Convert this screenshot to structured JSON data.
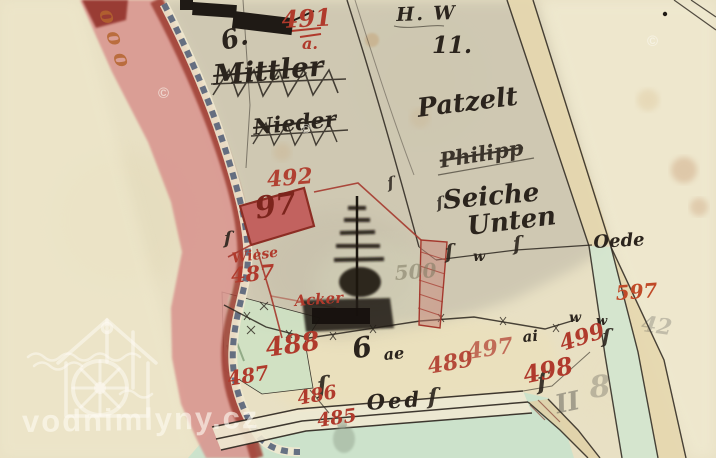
{
  "app": {
    "description": "scanned historical cadastral map sheet"
  },
  "watermark": {
    "text": "vodnimlyny.cz",
    "copyright_glyph": "©"
  },
  "colors": {
    "paper": "#e8e0c4",
    "map_wash": "#c9c3ae",
    "boundary_pink": "#d9958f",
    "boundary_dark_red": "#9e3c31",
    "chain_blue": "#44536f",
    "parcel_red_ink": "#b03a2c",
    "house_97_fill": "#c2625f",
    "green_meadow": "#c9e2cc",
    "road_tan": "#e6d7ae",
    "black_ink": "#2b241d"
  },
  "labels": [
    {
      "name": "hw-label",
      "text": "H. W",
      "x": 396,
      "y": 6,
      "size": 19,
      "rot": -2,
      "color": "#2b241d",
      "cls": "hand",
      "ls": 2
    },
    {
      "name": "parcel-11",
      "text": "11.",
      "x": 432,
      "y": 34,
      "size": 23,
      "rot": 0,
      "color": "#2b241d",
      "cls": "num"
    },
    {
      "name": "name-patzelt",
      "text": "Patzelt",
      "x": 416,
      "y": 96,
      "size": 26,
      "rot": -7,
      "color": "#2b241d",
      "cls": "hand"
    },
    {
      "name": "name-philipp",
      "text": "Philipp",
      "x": 438,
      "y": 150,
      "size": 21,
      "rot": -9,
      "color": "#2b241d",
      "cls": "hand",
      "deco": "line-through",
      "op": 0.9
    },
    {
      "name": "name-seiche",
      "text": "Seiche",
      "x": 442,
      "y": 188,
      "size": 26,
      "rot": -5,
      "color": "#2b241d",
      "cls": "hand"
    },
    {
      "name": "name-unten",
      "text": "Unten",
      "x": 466,
      "y": 214,
      "size": 26,
      "rot": -7,
      "color": "#2b241d",
      "cls": "hand"
    },
    {
      "name": "name-mittler-struck",
      "text": "Mittler",
      "x": 212,
      "y": 62,
      "size": 28,
      "rot": -5,
      "color": "#2b241d",
      "cls": "hand",
      "deco": "line-through"
    },
    {
      "name": "name-nieder-struck",
      "text": "Nieder",
      "x": 252,
      "y": 117,
      "size": 22,
      "rot": -6,
      "color": "#2b241d",
      "cls": "hand",
      "deco": "line-through"
    },
    {
      "name": "house-no-6",
      "text": "6.",
      "x": 218,
      "y": 30,
      "size": 26,
      "rot": -15,
      "color": "#2b241d",
      "cls": "hand"
    },
    {
      "name": "oede-label",
      "text": "Oede",
      "x": 593,
      "y": 234,
      "size": 18,
      "rot": -3,
      "color": "#2b241d",
      "cls": "hand"
    },
    {
      "name": "oed-road-label",
      "text": "Oed",
      "x": 366,
      "y": 392,
      "size": 21,
      "rot": -4,
      "color": "#2b241d",
      "cls": "hand",
      "ls": 3
    },
    {
      "name": "area-6",
      "text": "6",
      "x": 350,
      "y": 336,
      "size": 28,
      "rot": -10,
      "color": "#2b241d",
      "cls": "hand"
    },
    {
      "name": "area-ae",
      "text": "ae",
      "x": 383,
      "y": 347,
      "size": 16,
      "rot": -5,
      "color": "#2b241d",
      "cls": "hand"
    },
    {
      "name": "area-ai",
      "text": "ai",
      "x": 522,
      "y": 330,
      "size": 15,
      "rot": -5,
      "color": "#2b241d",
      "cls": "hand"
    },
    {
      "name": "wiese-mark-1",
      "text": "w",
      "x": 473,
      "y": 250,
      "size": 14,
      "rot": 0,
      "color": "#2b241d",
      "cls": "hand"
    },
    {
      "name": "wiese-mark-2",
      "text": "w",
      "x": 569,
      "y": 311,
      "size": 14,
      "rot": 0,
      "color": "#2b241d",
      "cls": "hand"
    },
    {
      "name": "wiese-mark-3",
      "text": "w",
      "x": 596,
      "y": 315,
      "size": 13,
      "rot": 0,
      "color": "#2b241d",
      "cls": "hand"
    },
    {
      "name": "hook-1",
      "text": "ſ",
      "x": 444,
      "y": 242,
      "size": 20,
      "rot": -5,
      "color": "#2b241d",
      "cls": "hand",
      "op": 0.9
    },
    {
      "name": "hook-2",
      "text": "ſ",
      "x": 512,
      "y": 234,
      "size": 20,
      "rot": -5,
      "color": "#2b241d",
      "cls": "hand",
      "op": 0.9
    },
    {
      "name": "hook-3",
      "text": "ſ",
      "x": 224,
      "y": 230,
      "size": 18,
      "rot": 0,
      "color": "#2b241d",
      "cls": "hand",
      "op": 0.9
    },
    {
      "name": "hook-4",
      "text": "ſ",
      "x": 316,
      "y": 374,
      "size": 24,
      "rot": -5,
      "color": "#2b241d",
      "cls": "hand",
      "op": 0.9
    },
    {
      "name": "hook-5",
      "text": "ſ",
      "x": 536,
      "y": 370,
      "size": 24,
      "rot": -5,
      "color": "#2b241d",
      "cls": "hand",
      "op": 0.9
    },
    {
      "name": "hook-6",
      "text": "ſ",
      "x": 602,
      "y": 326,
      "size": 20,
      "rot": 0,
      "color": "#2b241d",
      "cls": "hand",
      "op": 0.9
    },
    {
      "name": "hook-7",
      "text": "ſ",
      "x": 386,
      "y": 176,
      "size": 16,
      "rot": -10,
      "color": "#2b241d",
      "cls": "hand",
      "op": 0.85
    },
    {
      "name": "hook-8",
      "text": "ſ",
      "x": 435,
      "y": 196,
      "size": 16,
      "rot": -10,
      "color": "#2b241d",
      "cls": "hand",
      "op": 0.85
    },
    {
      "name": "hook-9",
      "text": "ſ",
      "x": 428,
      "y": 386,
      "size": 22,
      "rot": 0,
      "color": "#2b241d",
      "cls": "hand",
      "op": 0.9
    },
    {
      "name": "num-491",
      "text": "491",
      "x": 281,
      "y": 8,
      "size": 24,
      "rot": -3,
      "color": "#b03a2c",
      "cls": "num"
    },
    {
      "name": "num-491-a",
      "text": "a.",
      "x": 302,
      "y": 36,
      "size": 16,
      "rot": 0,
      "color": "#b03a2c",
      "cls": "hand"
    },
    {
      "name": "num-492",
      "text": "492",
      "x": 266,
      "y": 169,
      "size": 22,
      "rot": -5,
      "color": "#b03a2c",
      "cls": "num",
      "op": 0.95
    },
    {
      "name": "num-97",
      "text": "97",
      "x": 253,
      "y": 195,
      "size": 30,
      "rot": -9,
      "color": "#7c241c",
      "cls": "num"
    },
    {
      "name": "label-wiese",
      "text": "Wiese",
      "x": 231,
      "y": 252,
      "size": 14,
      "rot": -8,
      "color": "#b03a2c",
      "cls": "hand"
    },
    {
      "name": "num-487-a",
      "text": "487",
      "x": 230,
      "y": 265,
      "size": 21,
      "rot": -5,
      "color": "#b03a2c",
      "cls": "num"
    },
    {
      "name": "label-acker",
      "text": "Acker",
      "x": 294,
      "y": 294,
      "size": 15,
      "rot": -4,
      "color": "#b03a2c",
      "cls": "hand"
    },
    {
      "name": "num-488",
      "text": "488",
      "x": 264,
      "y": 336,
      "size": 26,
      "rot": -8,
      "color": "#b03a2c",
      "cls": "num"
    },
    {
      "name": "num-487-b",
      "text": "487",
      "x": 226,
      "y": 369,
      "size": 20,
      "rot": -9,
      "color": "#b03a2c",
      "cls": "num"
    },
    {
      "name": "num-486",
      "text": "486",
      "x": 296,
      "y": 390,
      "size": 19,
      "rot": -10,
      "color": "#b03a2c",
      "cls": "num"
    },
    {
      "name": "num-485",
      "text": "485",
      "x": 316,
      "y": 412,
      "size": 19,
      "rot": -8,
      "color": "#b03a2c",
      "cls": "num"
    },
    {
      "name": "num-489",
      "text": "489",
      "x": 426,
      "y": 356,
      "size": 22,
      "rot": -10,
      "color": "#b03a2c",
      "cls": "num",
      "op": 0.9
    },
    {
      "name": "num-497",
      "text": "497",
      "x": 466,
      "y": 341,
      "size": 22,
      "rot": -8,
      "color": "#b03a2c",
      "cls": "num",
      "op": 0.7
    },
    {
      "name": "num-498",
      "text": "498",
      "x": 521,
      "y": 364,
      "size": 24,
      "rot": -12,
      "color": "#b03a2c",
      "cls": "num"
    },
    {
      "name": "num-499",
      "text": "499",
      "x": 557,
      "y": 334,
      "size": 22,
      "rot": -18,
      "color": "#b03a2c",
      "cls": "num"
    },
    {
      "name": "num-597",
      "text": "597",
      "x": 615,
      "y": 283,
      "size": 20,
      "rot": -4,
      "color": "#c04a28",
      "cls": "num"
    },
    {
      "name": "num-500-faded",
      "text": "500",
      "x": 394,
      "y": 263,
      "size": 20,
      "rot": -4,
      "color": "rgba(125,120,96,0.55)",
      "cls": "num"
    },
    {
      "name": "pencil-II",
      "text": "II",
      "x": 553,
      "y": 393,
      "size": 26,
      "rot": -12,
      "color": "rgba(80,78,74,0.45)",
      "cls": "hand"
    },
    {
      "name": "pencil-8",
      "text": "8",
      "x": 588,
      "y": 374,
      "size": 30,
      "rot": -6,
      "color": "rgba(80,78,74,0.30)",
      "cls": "hand"
    },
    {
      "name": "pencil-42",
      "text": "42",
      "x": 643,
      "y": 313,
      "size": 22,
      "rot": 8,
      "color": "rgba(80,78,74,0.28)",
      "cls": "hand"
    },
    {
      "name": "boundary-script-illegible",
      "text": "ooo",
      "x": 116,
      "y": 6,
      "size": 22,
      "rot": 72,
      "color": "#b5652f",
      "cls": "hand",
      "ls": 8,
      "op": 0.85
    },
    {
      "name": "wm-copyright-1",
      "text": "©",
      "x": 158,
      "y": 86,
      "size": 15,
      "rot": 0,
      "color": "rgba(252,250,242,0.6)",
      "cls": "wm"
    },
    {
      "name": "wm-copyright-2",
      "text": "©",
      "x": 647,
      "y": 34,
      "size": 15,
      "rot": 0,
      "color": "rgba(252,250,242,0.6)",
      "cls": "wm"
    },
    {
      "name": "wm-copyright-3",
      "text": "©",
      "x": 301,
      "y": 122,
      "size": 13,
      "rot": 0,
      "color": "rgba(252,250,242,0.6)",
      "cls": "wm"
    }
  ]
}
